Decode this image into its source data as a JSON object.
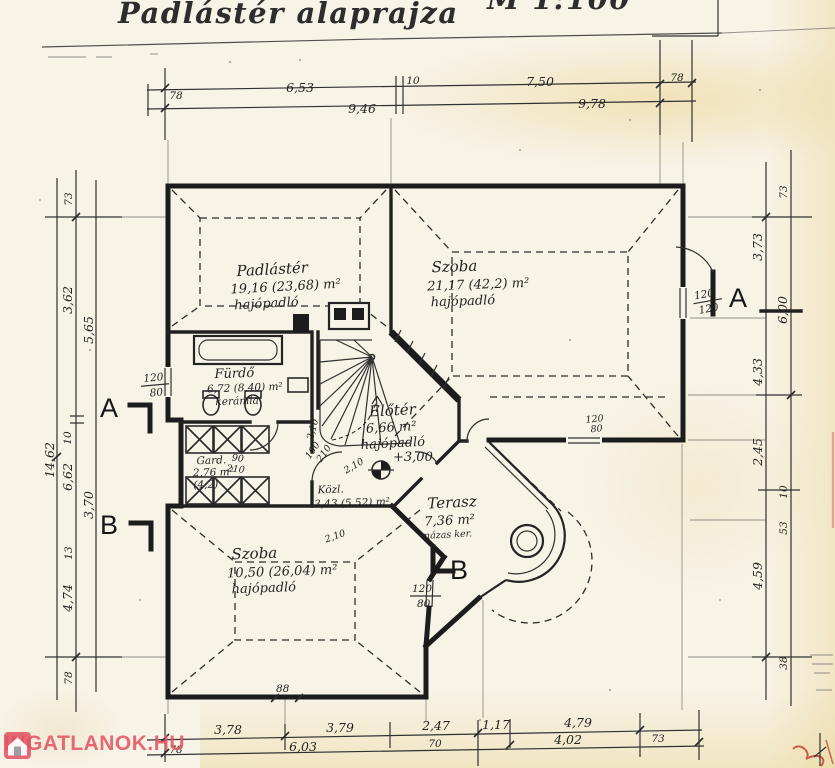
{
  "page": {
    "title": "Padlástér alaprajza",
    "scale": "M 1:100"
  },
  "watermark": {
    "text": "INGATLANOK.HU",
    "color": "#e25462",
    "icon": "house-icon"
  },
  "sections": {
    "a": "A",
    "b": "B"
  },
  "levels": {
    "eloter": "+3,00"
  },
  "rooms": {
    "padlaster": {
      "name": "Padlástér",
      "area": "19,16 (23,68) m²",
      "floor": "hajópadló"
    },
    "szoba_top": {
      "name": "Szoba",
      "area": "21,17 (42,2) m²",
      "floor": "hajópadló"
    },
    "furdo": {
      "name": "Fürdő",
      "area": "6,72 (8,40) m²",
      "floor": "kerámia"
    },
    "eloter": {
      "name": "Előtér",
      "area": "6,66 m²",
      "floor": "hajópadló"
    },
    "gard": {
      "name": "Gard.",
      "area": "2,76 m²",
      "note": "(4,2)"
    },
    "kozl": {
      "name": "Közl.",
      "area": "3,43 (5,52) m²"
    },
    "terasz": {
      "name": "Terasz",
      "area": "7,36 m²",
      "floor": "mázas ker."
    },
    "szoba_bottom": {
      "name": "Szoba",
      "area": "10,50 (26,04) m²",
      "floor": "hajópadló"
    }
  },
  "openings": {
    "window_left": {
      "w": "120",
      "h": "80"
    },
    "window_right": {
      "w": "120",
      "h": "120"
    },
    "window_mid": {
      "w": "120",
      "h": "80"
    },
    "window_bottom": {
      "w": "120",
      "h": "80"
    },
    "door_gard": {
      "w": "90",
      "h": "210"
    },
    "door_kozl": {
      "w": "100",
      "h": "210"
    },
    "headroom": "2,10",
    "chimney": "88"
  },
  "dims": {
    "top_row1": [
      "78",
      "6,53",
      "10",
      "7,50",
      "78"
    ],
    "top_row2": [
      "9,46",
      "9,78"
    ],
    "bottom_row1": [
      "3,78",
      "3,79",
      "2,47",
      "1,17",
      "4,79"
    ],
    "bottom_row2": [
      "78",
      "6,03",
      "70",
      "4,02",
      "73"
    ],
    "left_col": [
      "73",
      "3,62",
      "5,65",
      "10",
      "6,62",
      "3,70",
      "13",
      "4,74",
      "78",
      "14,62"
    ],
    "right_col": [
      "73",
      "3,73",
      "6,00",
      "4,33",
      "2,45",
      "10",
      "53",
      "4,59",
      "38"
    ]
  }
}
